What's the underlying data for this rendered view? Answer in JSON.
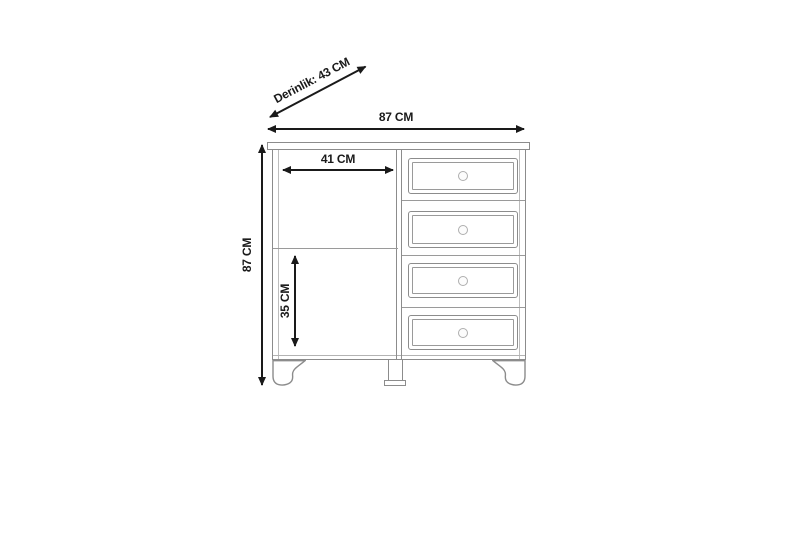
{
  "diagram": {
    "type": "furniture-dimension-drawing",
    "labels": {
      "depth": "Derinlik: 43 CM",
      "overall_width": "87 CM",
      "overall_height": "87 CM",
      "compartment_width": "41 CM",
      "compartment_height": "35 CM"
    },
    "drawer_count": 4,
    "colors": {
      "background": "#ffffff",
      "furniture_line": "#8c8c8c",
      "dimension_line": "#1a1a1a",
      "text": "#1a1a1a"
    }
  }
}
